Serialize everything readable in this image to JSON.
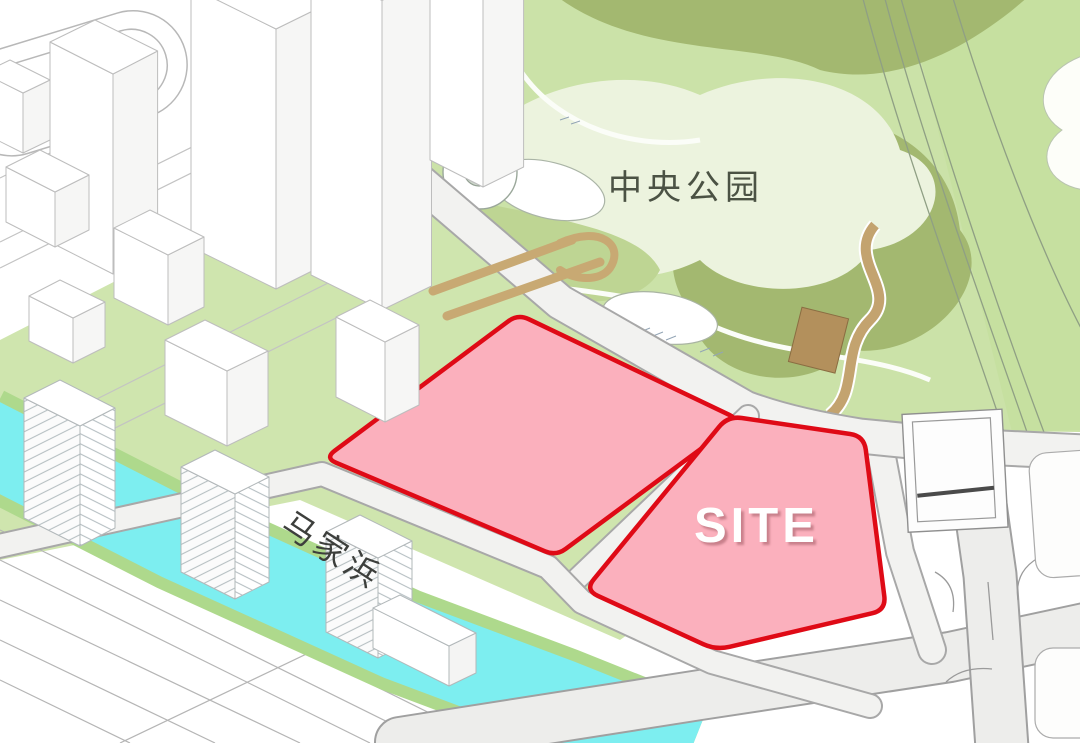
{
  "diagram": {
    "type": "architectural-site-plan",
    "view": "axonometric masterplan",
    "labels": {
      "park": "中央公园",
      "river": "马家浜",
      "site": "SITE"
    },
    "features": {
      "site_parcels": 2,
      "site_parcel_style": "pink fill with red boundary",
      "park_position": "top-right",
      "river_position": "lower-left diagonal",
      "city_blocks_position": "top-left"
    },
    "colors": {
      "park_green": "#cbe2a8",
      "park_dark_green": "#a3b870",
      "park_pale": "#ecf3de",
      "field_green": "#c6e0a0",
      "lawn_green": "#cfe5ae",
      "bank_green": "#aed98c",
      "river_cyan": "#7deef0",
      "parcel_pink": "#fbb0bd",
      "parcel_red": "#df0a16",
      "road_fill": "#f2f2f0",
      "road_edge": "#a5a5a5",
      "building_fill": "#ffffff",
      "building_stroke": "#bdbdbd",
      "bridge_tan": "#c8a973",
      "path_tan": "#c3a36f",
      "hut_brown": "#b3905c",
      "label_dark": "#4b5244",
      "site_label": "#ffffff"
    }
  }
}
